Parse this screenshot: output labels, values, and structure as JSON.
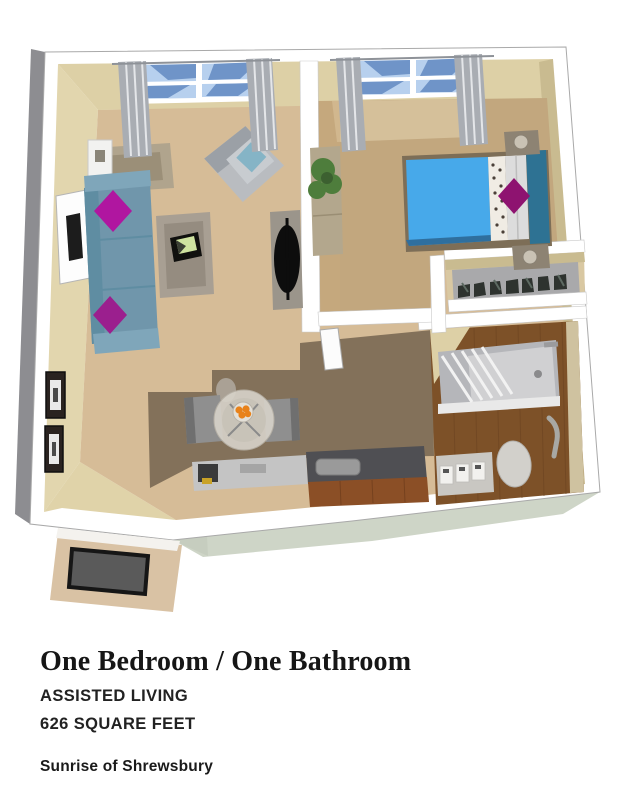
{
  "caption": {
    "title": "One Bedroom / One Bathroom",
    "care_level": "ASSISTED LIVING",
    "square_feet": "626 SQUARE FEET",
    "community": "Sunrise of Shrewsbury"
  },
  "palette": {
    "wall_top": "#ffffff",
    "wall_edge_dark": "#8d8d91",
    "wall_face": "#ddd0a6",
    "wall_face_light": "#e2d6ae",
    "wall_face_shadow": "#c9bb90",
    "exterior_base": "#ced5c7",
    "carpet_living": "#d6bc97",
    "carpet_bedroom": "#c2a77e",
    "carpet_bedroom_light": "#d5c09a",
    "carpet_dining": "#83715a",
    "floor_wood": "#7d5128",
    "floor_entry": "#d9c2a4",
    "doormat": "#5a5a5a",
    "sofa": "#7096ab",
    "accent_pillow": "#b016a0",
    "armchair": "#b9bcc0",
    "armchair_pillow": "#85b4c6",
    "bed_duvet": "#47a9ea",
    "bed_headboard": "#2e7293",
    "bed_pillow": "#dcdcdc",
    "bed_accent_pillow": "#8e1370",
    "table_wood": "#b0a48d",
    "counter_dark": "#4f4f53",
    "counter_light": "#c4c4c4",
    "cabinet_wood": "#8b4f26",
    "fixture_gray": "#b5b6ba",
    "curtain": "#a9adb3",
    "window_glass": "#b7d0ee",
    "window_glass_dark": "#6f94c8",
    "plant": "#4e7d3c",
    "fruit": "#e8821a"
  },
  "plan": {
    "rooms": [
      {
        "name": "living-room"
      },
      {
        "name": "bedroom"
      },
      {
        "name": "closet"
      },
      {
        "name": "bathroom"
      },
      {
        "name": "dining-nook"
      },
      {
        "name": "kitchenette"
      },
      {
        "name": "entry"
      }
    ]
  }
}
